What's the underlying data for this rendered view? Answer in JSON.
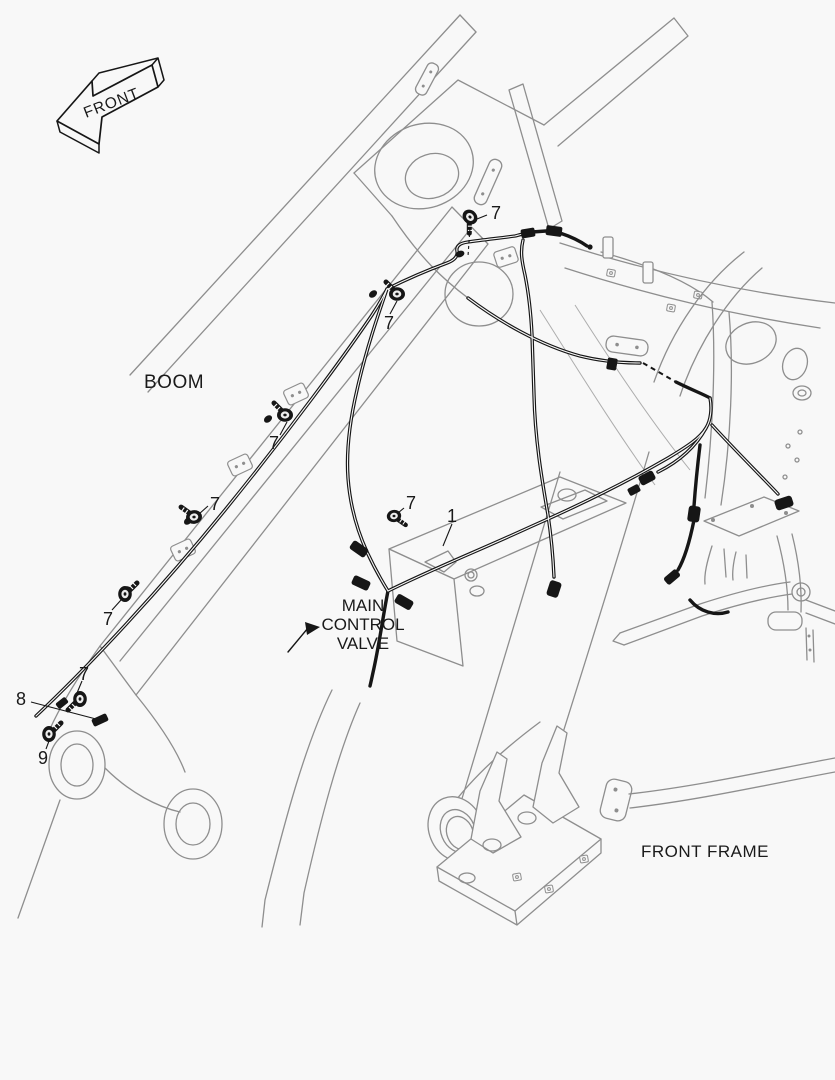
{
  "colors": {
    "background": "#f8f8f8",
    "structure_line": "#8e8e8e",
    "harness_line": "#161616",
    "text": "#1a1a1a"
  },
  "direction_arrow": {
    "label": "FRONT"
  },
  "labels": {
    "boom": "BOOM",
    "mcv_line1": "MAIN",
    "mcv_line2": "CONTROL",
    "mcv_line3": "VALVE",
    "front_frame": "FRONT FRAME"
  },
  "callouts": [
    {
      "label": "1"
    },
    {
      "label": "7"
    },
    {
      "label": "7"
    },
    {
      "label": "7"
    },
    {
      "label": "7"
    },
    {
      "label": "7"
    },
    {
      "label": "7"
    },
    {
      "label": "7"
    },
    {
      "label": "8"
    },
    {
      "label": "9"
    }
  ],
  "icons": {
    "bolt": "bolt-icon",
    "clip": "harness-clip-icon",
    "connector": "connector-icon",
    "direction": "front-direction-arrow-icon"
  }
}
